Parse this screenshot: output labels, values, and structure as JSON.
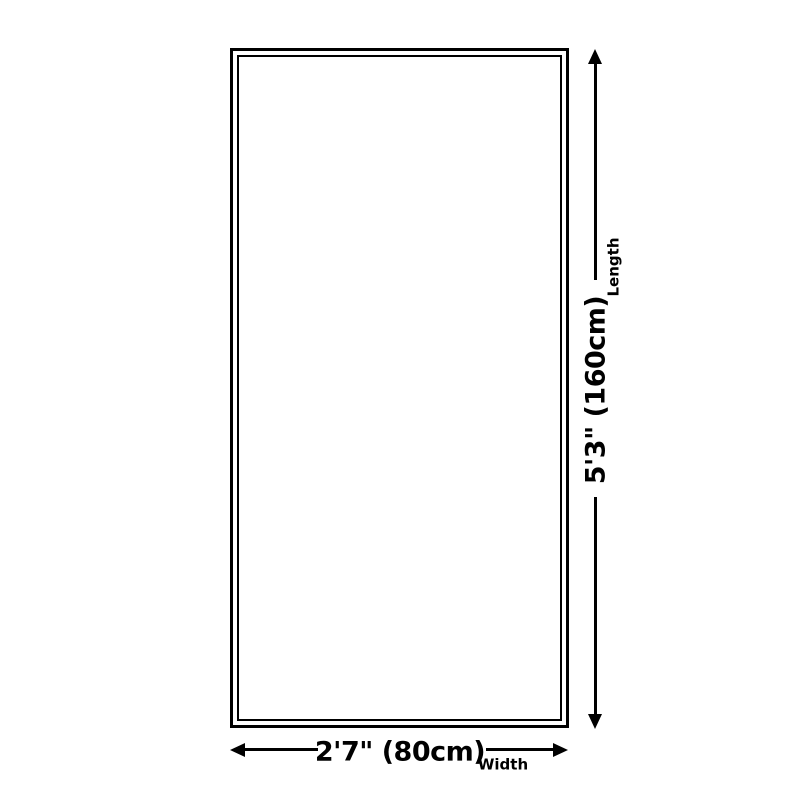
{
  "diagram": {
    "type": "product-dimension-diagram",
    "shape": "rectangle",
    "length": {
      "value": "5'3\" (160cm)",
      "label": "Length"
    },
    "width": {
      "value": "2'7\" (80cm)",
      "label": "Width"
    }
  },
  "colors": {
    "line": "#000000",
    "background": "#ffffff",
    "surface": "#ffffff"
  }
}
